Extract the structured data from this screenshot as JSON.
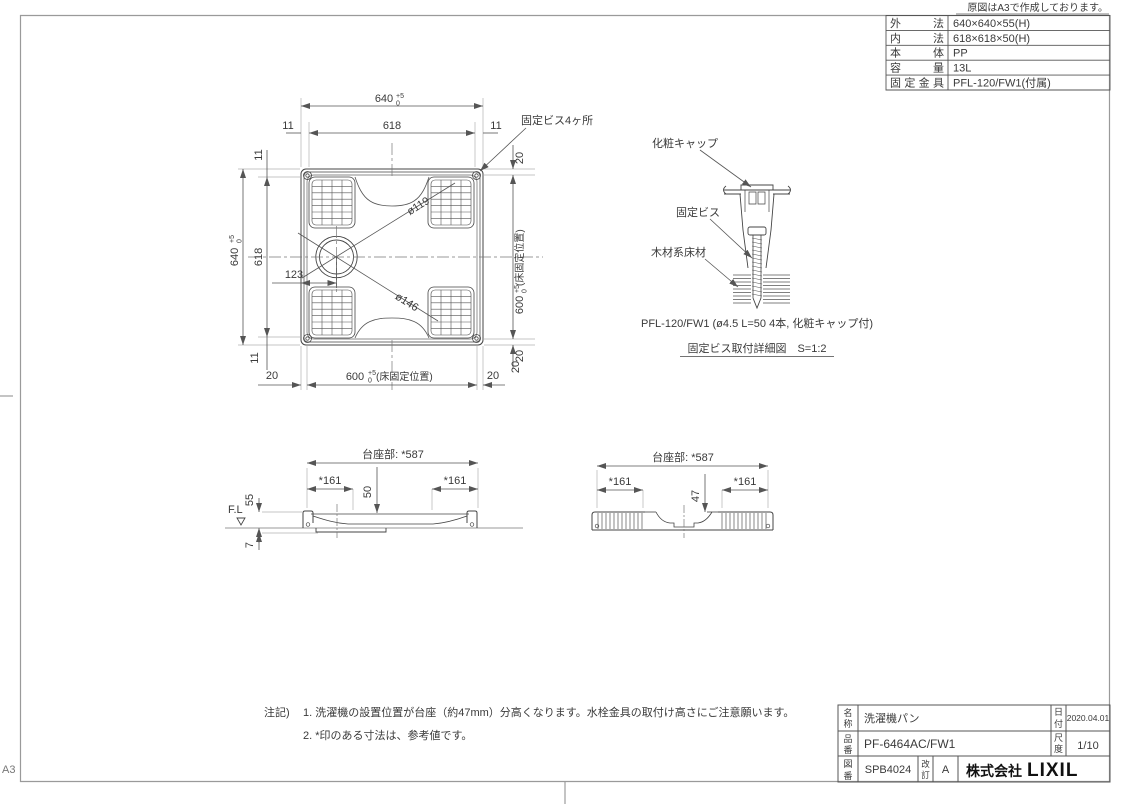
{
  "sheet": {
    "origin_note": "原図はA3で作成しております。",
    "size_label": "A3"
  },
  "spec_table": {
    "rows": [
      {
        "label": "外　　法",
        "value": "640×640×55(H)"
      },
      {
        "label": "内　　法",
        "value": "618×618×50(H)"
      },
      {
        "label": "本　　体",
        "value": "PP"
      },
      {
        "label": "容　　量",
        "value": "13L"
      },
      {
        "label": "固定金具",
        "value": "PFL-120/FW1(付属)"
      }
    ]
  },
  "plan": {
    "dim_640": "640",
    "tol_up": "+5",
    "tol_dn": "0",
    "dim_618": "618",
    "dim_11": "11",
    "dim_20": "20",
    "dim_123": "123",
    "dim_600": "600",
    "floor_fix_note": "(床固定位置)",
    "dia_inner": "ø119",
    "dia_outer": "ø146",
    "fix_screw_label": "固定ビス4ヶ所"
  },
  "detail": {
    "cap_label": "化粧キャップ",
    "screw_label": "固定ビス",
    "floor_label": "木材系床材",
    "spec_line": "PFL-120/FW1 (ø4.5 L=50 4本, 化粧キャップ付)",
    "caption": "固定ビス取付詳細図　S=1:2"
  },
  "section_a": {
    "pedestal": "台座部: *587",
    "dim_161": "*161",
    "dim_50": "50",
    "dim_55": "55",
    "dim_7": "7",
    "fl_label": "F.L"
  },
  "section_b": {
    "pedestal": "台座部: *587",
    "dim_161": "*161",
    "dim_47": "47"
  },
  "notes": {
    "heading": "注記)",
    "line1": "1. 洗濯機の設置位置が台座（約47mm）分高くなります。水栓金具の取付け高さにご注意願います。",
    "line2": "2. *印のある寸法は、参考値です。"
  },
  "title_block": {
    "name_label": [
      "名",
      "称"
    ],
    "name": "洗濯機パン",
    "part_label": [
      "品",
      "番"
    ],
    "part_no": "PF-6464AC/FW1",
    "dwg_label": [
      "図",
      "番"
    ],
    "dwg_no": "SPB4024",
    "rev_label": [
      "改",
      "訂"
    ],
    "rev": "A",
    "date_label": [
      "日",
      "付"
    ],
    "date": "2020.04.01",
    "scale_label": [
      "尺",
      "度"
    ],
    "scale": "1/10",
    "company_jp": "株式会社",
    "company_en": "LIXIL"
  }
}
